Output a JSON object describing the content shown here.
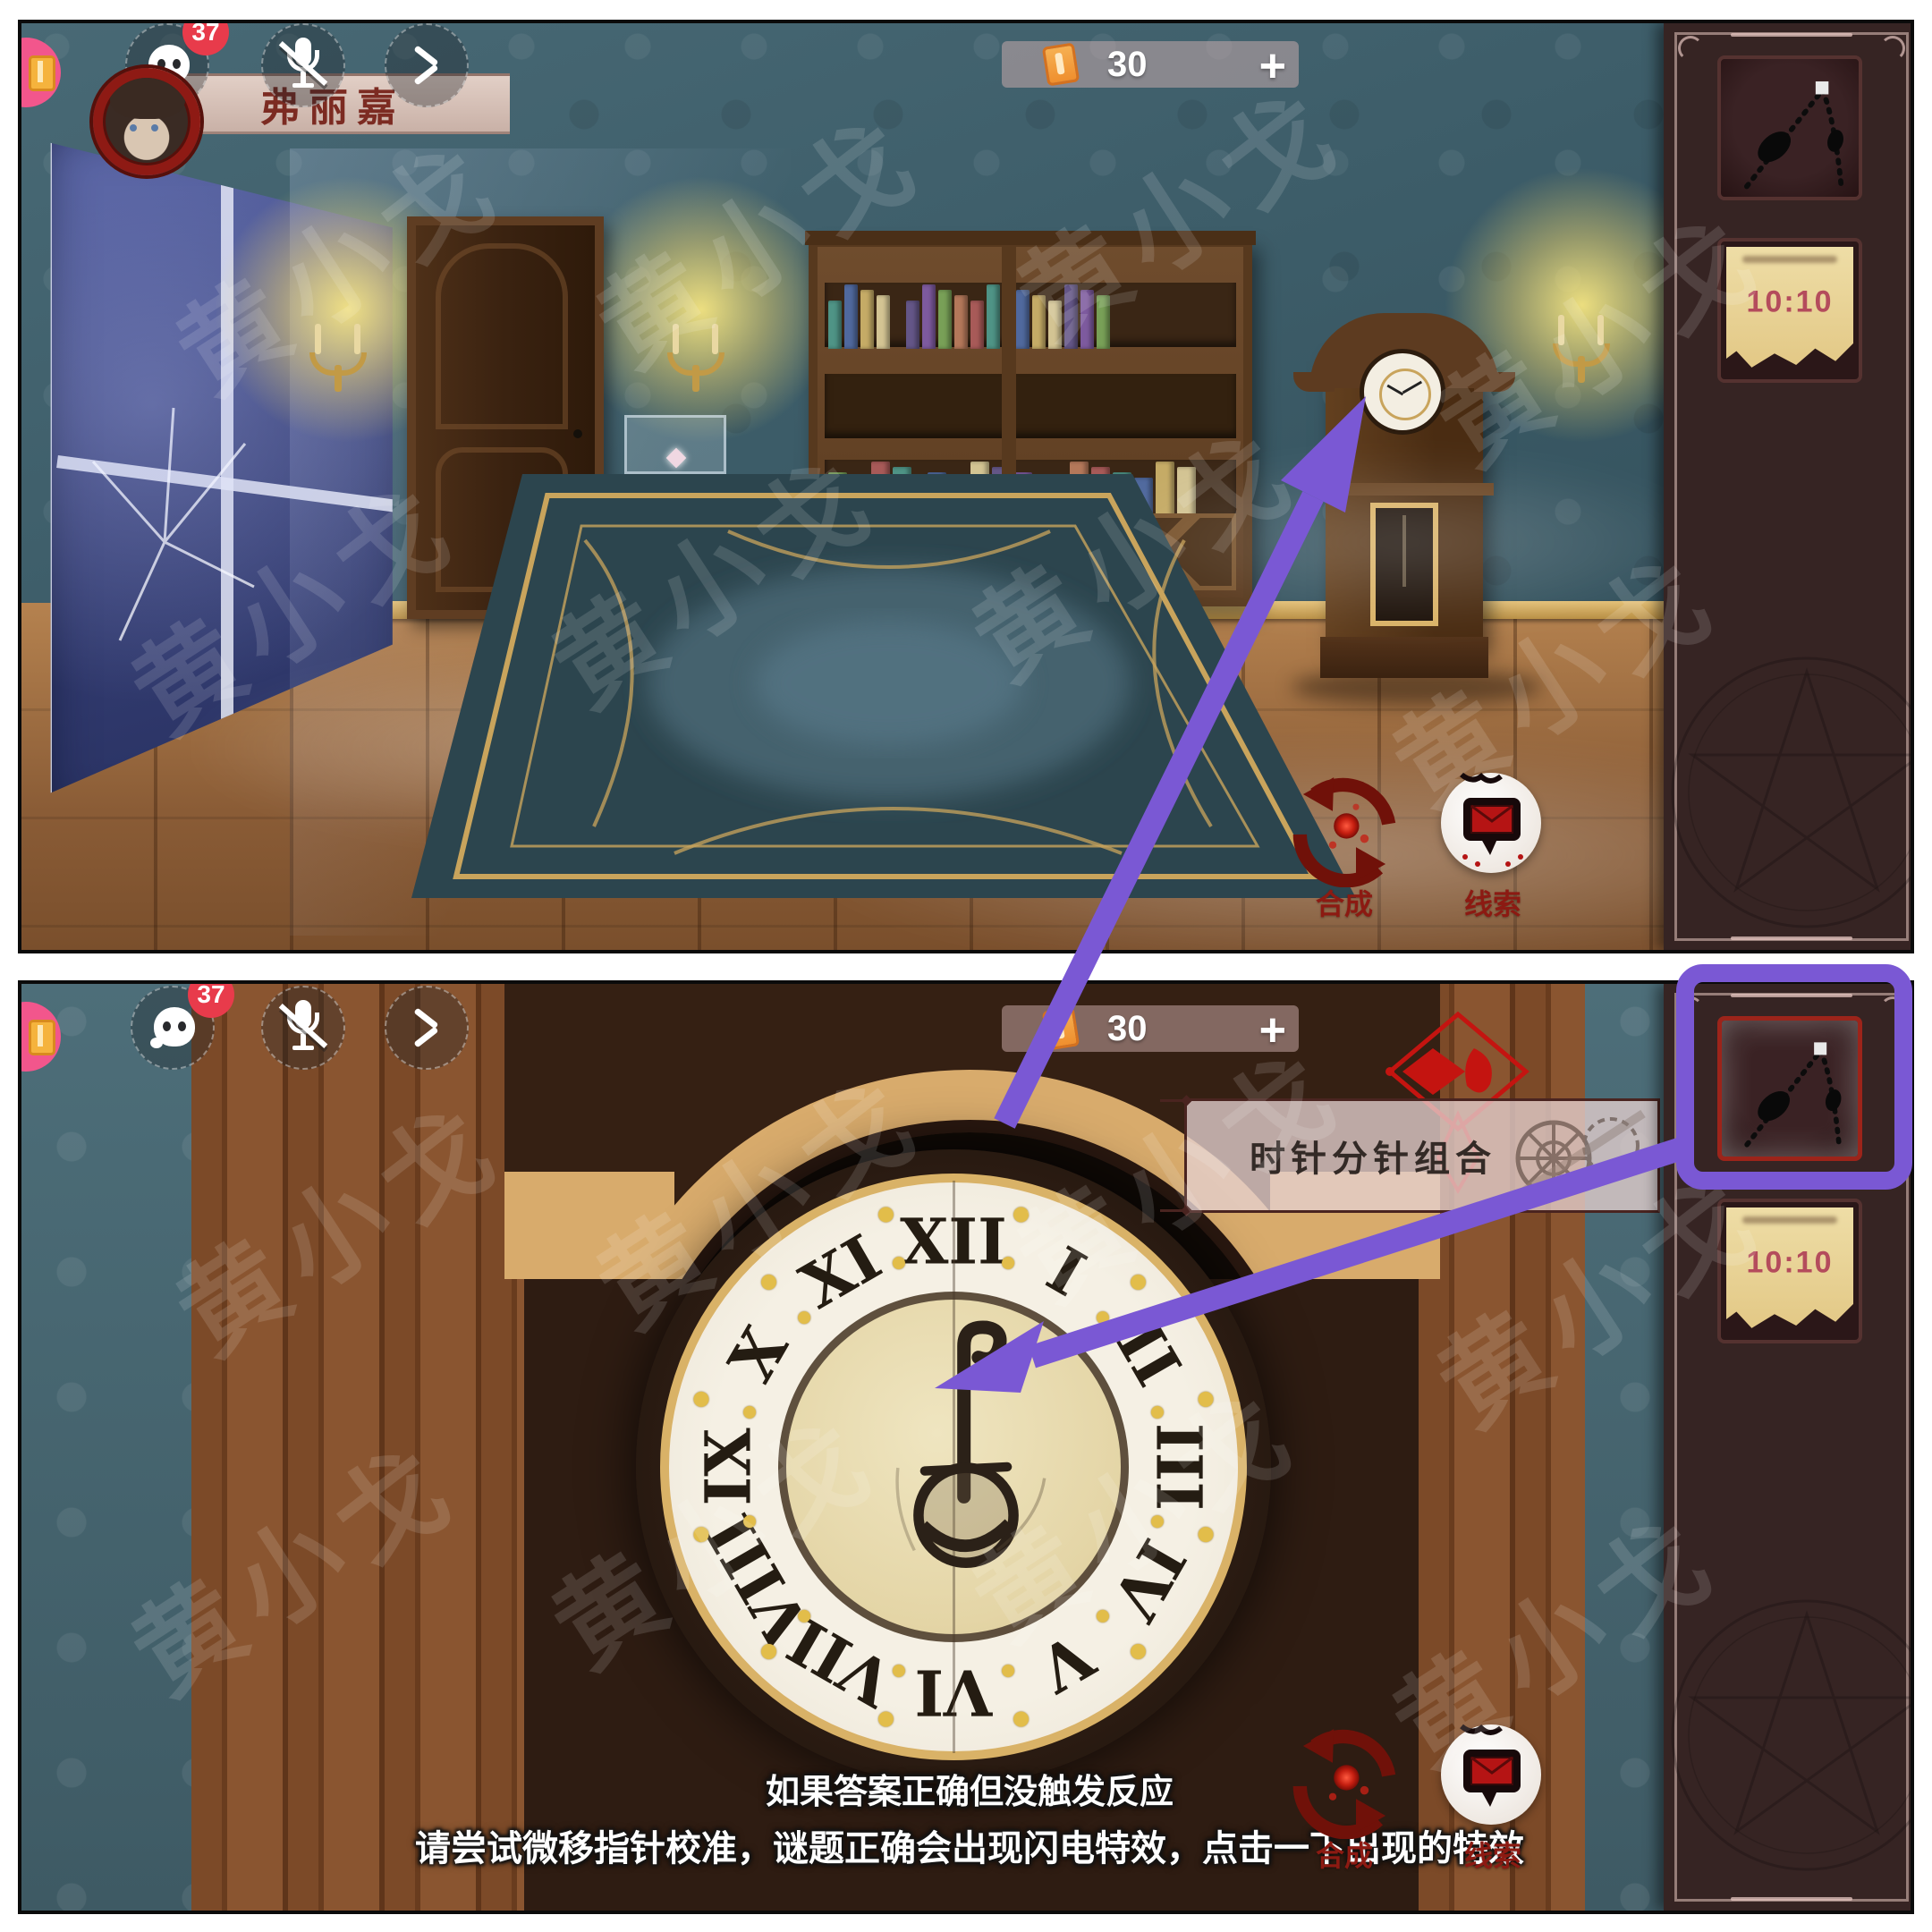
{
  "watermark": {
    "text": "黄小戈"
  },
  "hud": {
    "chat_badge": "37",
    "player_name": "弗丽嘉",
    "currency_amount": "30",
    "add_label": "+"
  },
  "buttons": {
    "synthesis_label": "合成",
    "clues_label": "线索"
  },
  "sidebar": {
    "items": [
      {
        "id": "clock-hands-item",
        "label": ""
      },
      {
        "id": "time-note-item",
        "label": "10:10"
      }
    ]
  },
  "bottom_panel": {
    "tooltip_label": "时针分针组合",
    "hint_line1": "如果答案正确但没触发反应",
    "hint_line2": "请尝试微移指针校准，谜题正确会出现闪电特效，点击一下出现的特效",
    "clock_numerals": [
      "XII",
      "I",
      "II",
      "III",
      "IV",
      "V",
      "VI",
      "VII",
      "VIII",
      "IX",
      "X",
      "XI"
    ]
  },
  "colors": {
    "annotation_purple": "#7a58d4",
    "accent_red": "#8c1a12",
    "gold": "#d9b267",
    "book_palette": [
      "#4f9486",
      "#c5ab66",
      "#645687",
      "#78a057",
      "#a85a58",
      "#50699e",
      "#d3c493",
      "#7d5a9e",
      "#b4785a"
    ]
  }
}
